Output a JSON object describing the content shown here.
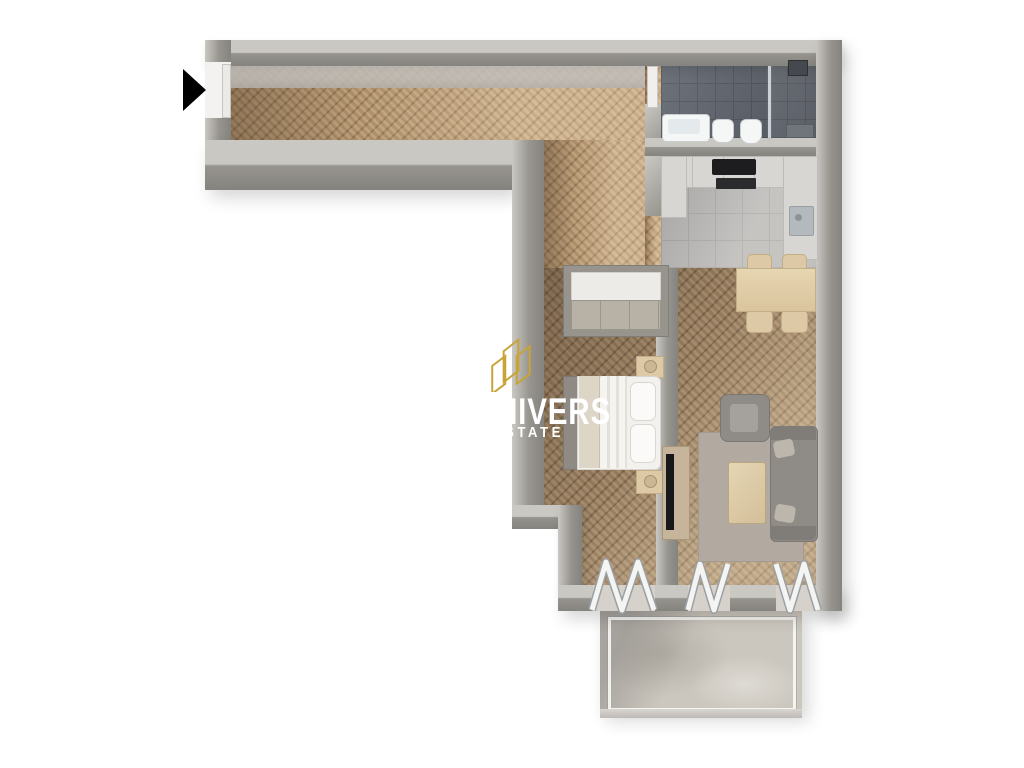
{
  "page": {
    "width": 1024,
    "height": 768,
    "background": "#ffffff"
  },
  "watermark": {
    "logo_icon": "gold-buildings-logo",
    "line1": "NIVERS",
    "line2": "STATE"
  },
  "entrance": {
    "arrow_icon": "entry-direction-arrow"
  },
  "palette": {
    "page-bg": "#ffffff",
    "wall": "#97948e",
    "wall-top": "#cac8c3",
    "wall-dark": "#85837e",
    "floor-hall": "#c2a076",
    "floor-wood": "#a78b69",
    "tile-bath": "#5d626b",
    "tile-bath-line": "#4e525a",
    "tile-kitchen": "#b7b5b2",
    "tile-kitchen-line": "#a6a4a1",
    "concrete": "#ccc7be",
    "white-fixture": "#f5f6f6",
    "counter": "#d8d6d2",
    "appliance": "#1d1d1f",
    "wood-furniture": "#ddc9a5",
    "sofa": "#8f8c87",
    "rug": "#b2aaa0",
    "bedding": "#f3f1ed",
    "wm-gold": "#C8A336",
    "wm-text": "#ffffff",
    "arrow": "#000000"
  },
  "rooms": [
    {
      "name": "hallway"
    },
    {
      "name": "bathroom"
    },
    {
      "name": "kitchen"
    },
    {
      "name": "dining-area"
    },
    {
      "name": "bedroom"
    },
    {
      "name": "living-room"
    },
    {
      "name": "balcony"
    }
  ],
  "furniture": {
    "bathroom": [
      "washbasin",
      "bidet",
      "toilet",
      "shower"
    ],
    "kitchen": [
      "cabinet-run",
      "cooktop",
      "oven",
      "sink"
    ],
    "dining": [
      "dining-table",
      "chairs-x4"
    ],
    "bedroom": [
      "wardrobe",
      "double-bed",
      "nightstand-x2"
    ],
    "living": [
      "tv-stand",
      "tv",
      "armchair",
      "sofa",
      "coffee-table",
      "rug"
    ],
    "balcony": [
      "folding-glass-doors-x3",
      "glass-railing"
    ]
  }
}
